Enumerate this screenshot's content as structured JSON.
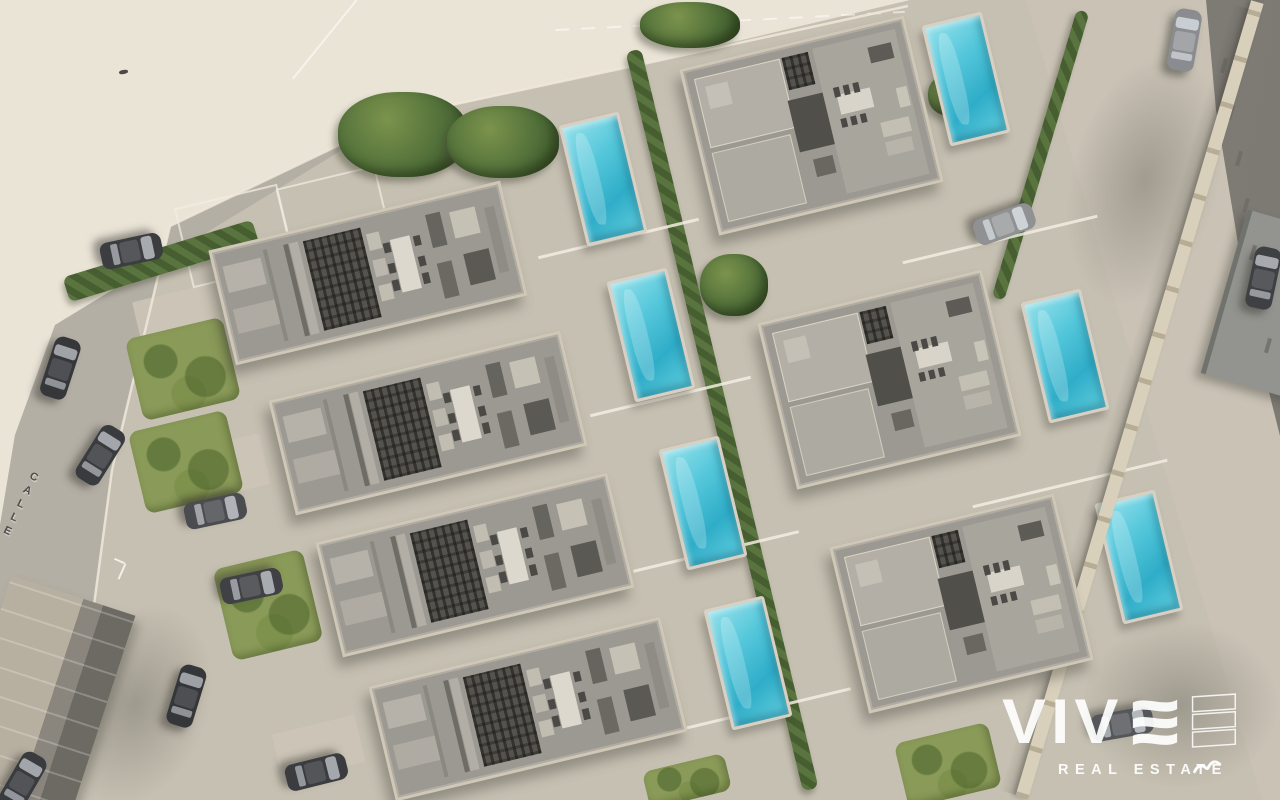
{
  "scene": {
    "type": "aerial-3d-render",
    "subject": "Top-down 3D render of a residential development: rows of modern villas with rooftop terraces, private pools, gardens, perimeter wall and parked cars along the streets",
    "street_label": "CALLE",
    "watermark": {
      "brand": "VIVE",
      "brand_text_part": "VIV",
      "tagline": "REAL ESTATE"
    },
    "palette": {
      "ground": "#c6c0b2",
      "pale_lot": "#eae4d7",
      "street": "#b4afa5",
      "roof": "#9c9992",
      "roof_dark": "#55534d",
      "parapet": "#d0c8b6",
      "pool_water": "#4fc4da",
      "pool_deck": "#d8d1c3",
      "grass": "#8a9a58",
      "bush": "#52703a",
      "road_dark": "#87847e",
      "wall": "#d9d0bc",
      "car_dark": "#3a3b3e",
      "watermark_white": "#ffffff"
    },
    "counts": {
      "long_villas": 4,
      "square_villas": 3,
      "pools": 7,
      "cars": 12
    },
    "long_villas": [
      [
        365,
        270
      ],
      [
        425,
        420
      ],
      [
        472,
        562
      ],
      [
        525,
        706
      ]
    ],
    "square_villas": [
      [
        808,
        122
      ],
      [
        886,
        376
      ],
      [
        958,
        600
      ]
    ],
    "rotation_deg": -13.5,
    "pools": [
      [
        600,
        176
      ],
      [
        648,
        332
      ],
      [
        700,
        500
      ],
      [
        745,
        660
      ],
      [
        963,
        76
      ],
      [
        1062,
        353
      ],
      [
        1136,
        554
      ]
    ],
    "cars": [
      [
        131,
        251,
        78,
        "#3c3d40",
        "#a7abb0",
        "#55575b"
      ],
      [
        60,
        368,
        18,
        "#36373a",
        "#9fa3a8",
        "#4e5054"
      ],
      [
        100,
        455,
        32,
        "#3a3b3e",
        "#a3a7ac",
        "#525458"
      ],
      [
        215,
        511,
        78,
        "#4a4c4f",
        "#b0b4b9",
        "#646669"
      ],
      [
        251,
        586,
        78,
        "#404144",
        "#a8acb1",
        "#595b5e"
      ],
      [
        186,
        696,
        17,
        "#353639",
        "#9da1a6",
        "#4d4f53"
      ],
      [
        316,
        772,
        76,
        "#3b3c3f",
        "#a4a8ad",
        "#535558"
      ],
      [
        1004,
        224,
        70,
        "#8f9193",
        "#ced3d8",
        "#a8aaac"
      ],
      [
        1184,
        40,
        10,
        "#8a8c8f",
        "#c9ced4",
        "#a3a5a8"
      ],
      [
        1263,
        278,
        12,
        "#3f4043",
        "#a6aaaf",
        "#58595d"
      ],
      [
        1122,
        724,
        80,
        "#55565a",
        "#b4b8bd",
        "#6e7074"
      ],
      [
        22,
        782,
        30,
        "#3a3b3e",
        "#a2a6ab",
        "#525458"
      ]
    ],
    "greens": {
      "bushes": [
        [
          403,
          134,
          130,
          85
        ],
        [
          503,
          142,
          112,
          72
        ],
        [
          690,
          25,
          100,
          46
        ],
        [
          734,
          285,
          68,
          62
        ],
        [
          181,
          358,
          62,
          52
        ],
        [
          951,
          95,
          46,
          42
        ]
      ],
      "grass": [
        [
          183,
          369,
          100,
          84
        ],
        [
          186,
          462,
          100,
          84
        ],
        [
          268,
          605,
          92,
          94
        ],
        [
          687,
          781,
          84,
          38
        ],
        [
          948,
          765,
          96,
          66
        ]
      ],
      "hedges": [
        [
          161,
          261,
          198,
          26,
          -17
        ],
        [
          722,
          420,
          16,
          760,
          -13.5
        ],
        [
          1040,
          155,
          13,
          300,
          16.5
        ]
      ]
    },
    "dividers": [
      [
        618,
        237,
        165
      ],
      [
        670,
        395,
        165
      ],
      [
        716,
        550,
        170
      ],
      [
        768,
        707,
        170
      ],
      [
        1000,
        238,
        200
      ],
      [
        1070,
        482,
        200
      ]
    ],
    "driveways": [
      [
        178,
        318,
        82,
        52
      ],
      [
        225,
        468,
        82,
        52
      ],
      [
        268,
        608,
        85,
        52
      ],
      [
        318,
        748,
        85,
        48
      ]
    ],
    "parking_outlines": [
      [
        233,
        234,
        102,
        78
      ],
      [
        332,
        212,
        98,
        72
      ]
    ],
    "road_dashes": {
      "from": [
        1222,
        58
      ],
      "to": [
        1266,
        338
      ],
      "count": 7
    }
  }
}
